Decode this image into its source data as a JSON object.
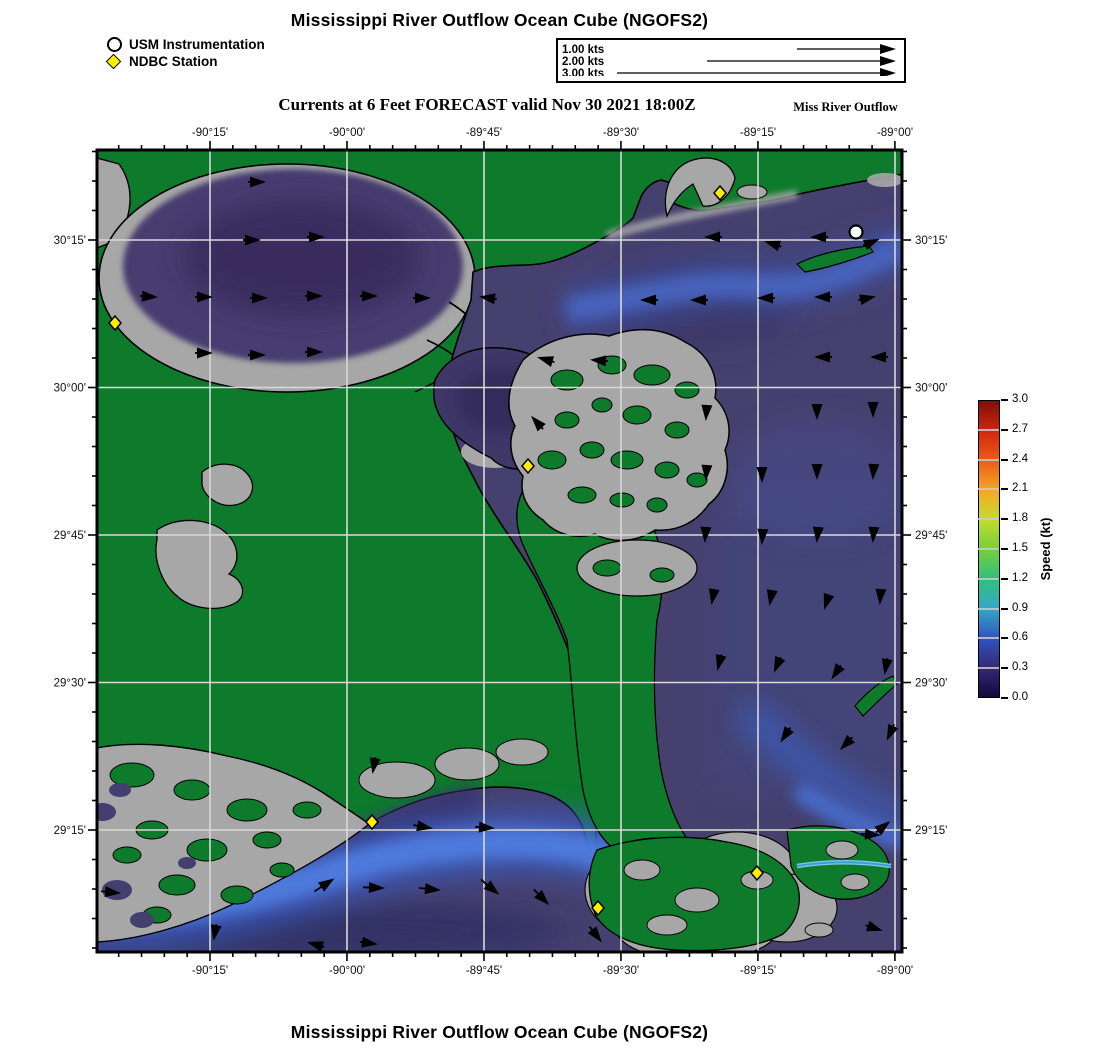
{
  "header": {
    "title": "Mississippi River Outflow Ocean Cube (NGOFS2)",
    "legend": [
      {
        "icon": "circle-marker",
        "label": "USM Instrumentation"
      },
      {
        "icon": "diamond-marker",
        "label": "NDBC Station"
      }
    ],
    "scale_box": {
      "rows": [
        {
          "label": "1.00 kts",
          "tail_start": 239
        },
        {
          "label": "2.00 kts",
          "tail_start": 149
        },
        {
          "label": "3.00 kts",
          "tail_start": 59
        }
      ]
    },
    "subtitle": "Currents at 6 Feet FORECAST valid Nov 30 2021 18:00Z",
    "subtitle_right": "Miss River Outflow"
  },
  "footer": {
    "title": "Mississippi River Outflow Ocean Cube (NGOFS2)"
  },
  "chart_data": {
    "type": "map",
    "subject": "surface current speed and direction forecast",
    "projection": {
      "lon_min": -90.456,
      "lon_max": -88.987,
      "lat_min": 29.043,
      "lat_max": 30.403
    },
    "x_axis": {
      "labels": [
        "-90°15'",
        "-90°00'",
        "-89°45'",
        "-89°30'",
        "-89°15'",
        "-89°00'"
      ],
      "px": [
        113,
        250,
        387,
        524,
        661,
        798
      ],
      "minor_step_px": 22.83
    },
    "y_axis": {
      "labels": [
        "30°15'",
        "30°00'",
        "29°45'",
        "29°30'",
        "29°15'"
      ],
      "px": [
        90,
        237.5,
        385,
        532.5,
        680
      ],
      "minor_step_px": 29.5
    },
    "grid": "on",
    "colorbar": {
      "title": "Speed (kt)",
      "min": 0.0,
      "max": 3.0,
      "step": 0.3,
      "tick_labels": [
        "3.0",
        "2.7",
        "2.4",
        "2.1",
        "1.8",
        "1.5",
        "1.2",
        "0.9",
        "0.6",
        "0.3",
        "0.0"
      ],
      "colors_low_to_high": [
        "#14083c",
        "#342a76",
        "#2f55c0",
        "#35a8c9",
        "#2ec27a",
        "#76cf3d",
        "#c4dc2e",
        "#f5a623",
        "#ec5c17",
        "#d0260e",
        "#7f100a"
      ]
    },
    "map_colors": {
      "land": "#0e7a2b",
      "marsh": "#a7a7a7",
      "water_base": "#46406f",
      "plume_bright": "#4f7de0",
      "gridline": "#d9d9d9"
    },
    "stations": {
      "usm_instrumentation_px": [
        [
          759,
          82
        ]
      ],
      "ndbc_stations_px": [
        [
          18,
          173
        ],
        [
          623,
          43
        ],
        [
          431,
          316
        ],
        [
          275,
          672
        ],
        [
          501,
          758
        ],
        [
          660,
          723
        ]
      ]
    },
    "current_vectors_px_angle_tail": [
      [
        166,
        32,
        0,
        6
      ],
      [
        161,
        90,
        0,
        6
      ],
      [
        225,
        87,
        0,
        6
      ],
      [
        58,
        147,
        4,
        6
      ],
      [
        113,
        147,
        0,
        6
      ],
      [
        168,
        148,
        0,
        6
      ],
      [
        223,
        146,
        0,
        6
      ],
      [
        278,
        146,
        0,
        6
      ],
      [
        331,
        148,
        0,
        6
      ],
      [
        113,
        203,
        0,
        6
      ],
      [
        166,
        205,
        0,
        6
      ],
      [
        223,
        202,
        0,
        6
      ],
      [
        610,
        87,
        180,
        6
      ],
      [
        670,
        92,
        198,
        6
      ],
      [
        716,
        87,
        180,
        6
      ],
      [
        780,
        90,
        -22,
        6
      ],
      [
        546,
        150,
        180,
        6
      ],
      [
        596,
        150,
        180,
        6
      ],
      [
        663,
        148,
        180,
        6
      ],
      [
        720,
        147,
        180,
        6
      ],
      [
        776,
        147,
        -12,
        6
      ],
      [
        385,
        147,
        188,
        6
      ],
      [
        443,
        208,
        196,
        6
      ],
      [
        496,
        210,
        184,
        6
      ],
      [
        720,
        207,
        180,
        6
      ],
      [
        776,
        207,
        180,
        6
      ],
      [
        436,
        268,
        228,
        6
      ],
      [
        609,
        268,
        94,
        4
      ],
      [
        720,
        267,
        90,
        4
      ],
      [
        776,
        265,
        90,
        4
      ],
      [
        609,
        328,
        94,
        4
      ],
      [
        665,
        330,
        90,
        4
      ],
      [
        720,
        327,
        90,
        4
      ],
      [
        776,
        327,
        94,
        4
      ],
      [
        608,
        390,
        94,
        4
      ],
      [
        665,
        392,
        94,
        4
      ],
      [
        720,
        390,
        96,
        4
      ],
      [
        776,
        390,
        94,
        4
      ],
      [
        615,
        452,
        100,
        4
      ],
      [
        673,
        453,
        100,
        4
      ],
      [
        728,
        457,
        108,
        4
      ],
      [
        783,
        452,
        94,
        4
      ],
      [
        621,
        518,
        104,
        5
      ],
      [
        678,
        520,
        114,
        5
      ],
      [
        736,
        527,
        124,
        5
      ],
      [
        788,
        522,
        100,
        5
      ],
      [
        685,
        590,
        124,
        6
      ],
      [
        745,
        598,
        134,
        6
      ],
      [
        791,
        588,
        114,
        6
      ],
      [
        21,
        743,
        6,
        8
      ],
      [
        117,
        788,
        100,
        5
      ],
      [
        213,
        793,
        196,
        6
      ],
      [
        278,
        794,
        8,
        6
      ],
      [
        235,
        730,
        -33,
        12
      ],
      [
        285,
        738,
        2,
        10
      ],
      [
        341,
        740,
        6,
        10
      ],
      [
        400,
        743,
        40,
        12
      ],
      [
        450,
        753,
        46,
        10
      ],
      [
        503,
        790,
        52,
        8
      ],
      [
        276,
        621,
        100,
        5
      ],
      [
        333,
        678,
        10,
        8
      ],
      [
        395,
        678,
        4,
        8
      ],
      [
        781,
        685,
        4,
        8
      ],
      [
        791,
        673,
        -38,
        6
      ],
      [
        783,
        780,
        18,
        6
      ]
    ]
  }
}
